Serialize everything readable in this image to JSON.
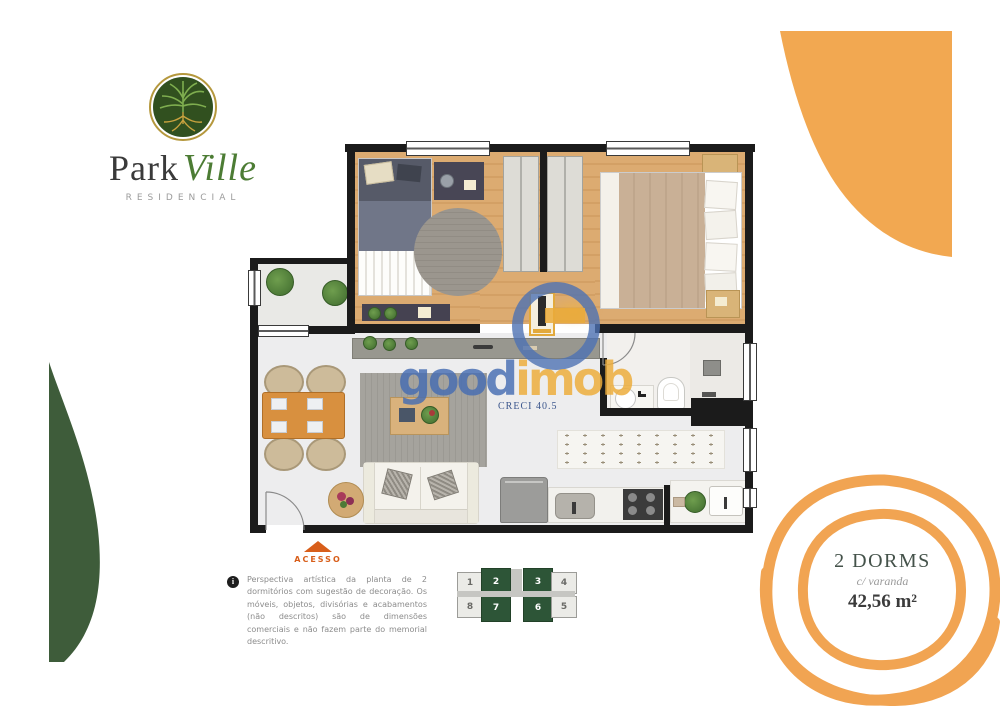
{
  "brand": {
    "part1": "Park",
    "part2": "Ville",
    "subtitle": "RESIDENCIAL"
  },
  "watermark": {
    "part1": "good",
    "part2": "imob",
    "creci": "CRECI 40.5"
  },
  "unit": {
    "dorms": "2 DORMS",
    "feature": "c/ varanda",
    "area": "42,56 m²"
  },
  "access": {
    "label": "ACESSO"
  },
  "disclaimer": {
    "info_icon": "i",
    "text": "Perspectiva artística da planta de 2 dormitórios com sugestão de decoração. Os móveis, objetos, divisórias e acabamentos (não descritos) são de dimensões comerciais e não fazem parte do memorial descritivo."
  },
  "keyplan": {
    "units": [
      {
        "label": "1",
        "highlighted": false
      },
      {
        "label": "2",
        "highlighted": true
      },
      {
        "label": "3",
        "highlighted": true
      },
      {
        "label": "4",
        "highlighted": false
      },
      {
        "label": "8",
        "highlighted": false
      },
      {
        "label": "7",
        "highlighted": true
      },
      {
        "label": "6",
        "highlighted": true
      },
      {
        "label": "5",
        "highlighted": false
      }
    ]
  },
  "colors": {
    "accent_orange": "#F2A851",
    "brand_green": "#3E5C3A",
    "keyplan_green": "#2d5537",
    "access_orange": "#d85e1a",
    "watermark_blue": "#466CB2",
    "watermark_yellow": "#ECAD3C"
  }
}
